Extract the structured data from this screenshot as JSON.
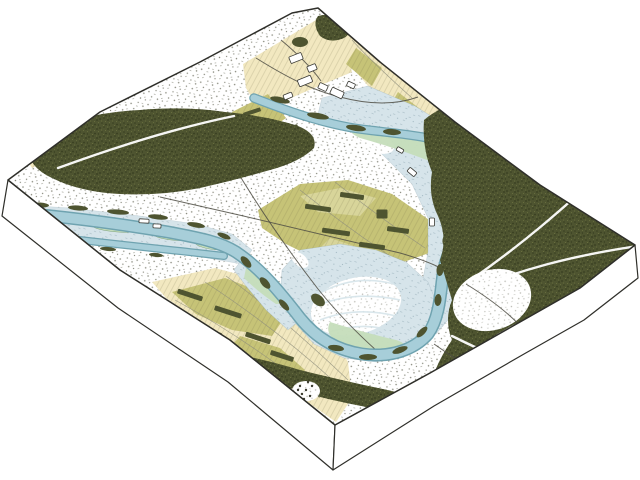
{
  "scene": {
    "type": "isometric-block-map-illustration",
    "background": "#ffffff",
    "depicted_features": [
      "river-channel",
      "oxbow-meander",
      "floodplain",
      "gravel-bars",
      "coniferous-forest",
      "forest-trails",
      "farm-fields",
      "hedgerows",
      "scrubland-stipple",
      "buildings",
      "roads",
      "channel-islands"
    ]
  },
  "colors": {
    "outline": "#2f2f2a",
    "forest": "#4e5430",
    "forest_dark": "#373e20",
    "forest_light": "#6b7240",
    "cream": "#f2e8c0",
    "olive": "#c6c377",
    "olive_light": "#d8d59a",
    "river_fill": "#a7ced9",
    "river_edge": "#6fa3b0",
    "flood": "#d6e4ea",
    "flood_mark": "#7d98a4",
    "marsh": "#c5ddbb",
    "stipple": "#5d5e4d",
    "road": "#4f4e44"
  },
  "map": {
    "field_patches": [
      {
        "d": "M243,64 L316,20 L345,42 L352,72 L300,94 L260,112 L246,88 Z",
        "cls": "cream"
      },
      {
        "d": "M330,16 L354,34 L400,70 L442,104 L452,126 L418,132 L380,100 L346,60 L320,30 Z",
        "cls": "cream"
      },
      {
        "d": "M356,48 L382,68 L372,86 L346,64 Z",
        "cls": "olive"
      },
      {
        "d": "M398,92 L424,112 L412,126 L390,106 Z",
        "cls": "olive"
      },
      {
        "d": "M232,112 L268,94 L286,118 L258,138 L236,130 Z",
        "cls": "olive"
      },
      {
        "d": "M20,150 L48,138 L60,154 L32,168 Z",
        "cls": "cream"
      },
      {
        "d": "M152,282 L215,268 L268,282 L305,302 L332,330 L348,362 L352,398 L336,422 L290,390 L240,352 L196,318 L166,298 Z",
        "cls": "cream"
      },
      {
        "d": "M172,292 L225,278 L262,292 L288,312 L272,336 L232,330 L196,314 Z",
        "cls": "olive"
      },
      {
        "d": "M240,336 L280,348 L305,370 L290,388 L252,366 L228,350 Z",
        "cls": "olive"
      },
      {
        "d": "M258,210 L300,184 L348,180 L392,194 L418,212 L440,228 L432,252 L398,264 L360,272 L322,262 L286,244 L262,228 Z",
        "cls": "olive"
      },
      {
        "d": "M300,196 L340,188 L376,198 L360,216 L318,212 Z",
        "cls": "olive2"
      },
      {
        "d": "M330,238 L372,252 L350,262 L316,252 Z",
        "cls": "olive2"
      }
    ],
    "field_lines": [
      {
        "d": "M175,300 C230,330 280,365 320,398"
      },
      {
        "d": "M205,282 C255,315 300,350 338,385"
      },
      {
        "d": "M226,276 C268,306 310,344 348,380"
      },
      {
        "d": "M300,190 C330,214 360,236 390,256"
      },
      {
        "d": "M335,182 C365,206 395,228 425,248"
      },
      {
        "d": "M352,40 C370,60 392,80 412,98"
      }
    ],
    "floodplain_zones": [
      {
        "d": "M322,98 L368,86 L415,106 L458,133 L492,166 L506,202 L498,240 L478,276 L458,308 L436,334 L412,318 L422,284 L428,252 L428,218 L412,184 L382,154 L348,130 L318,114 Z"
      },
      {
        "d": "M300,250 L340,244 L376,250 L406,262 L428,282 L438,306 L430,332 L406,352 L376,362 L344,358 L314,344 L294,322 L280,298 L282,270 Z"
      },
      {
        "d": "M6,204 L70,208 L140,216 L196,224 L232,234 L252,250 L242,264 L196,256 L130,248 L60,240 L6,236 Z"
      },
      {
        "d": "M240,262 L262,272 L286,296 L300,320 L288,330 L266,310 L246,286 L234,270 Z"
      }
    ],
    "gravel_bars": [
      {
        "x": 374,
        "y": 142,
        "rx": 21,
        "ry": 10,
        "r": 20
      },
      {
        "x": 480,
        "y": 196,
        "rx": 13,
        "ry": 7,
        "r": 75
      },
      {
        "x": 356,
        "y": 306,
        "rx": 46,
        "ry": 28,
        "r": -14
      },
      {
        "x": 300,
        "y": 260,
        "rx": 10,
        "ry": 6,
        "r": 40
      }
    ],
    "scroll_arcs": [
      {
        "d": "M322,292 Q356,274 394,284"
      },
      {
        "d": "M316,306 Q354,290 400,300"
      },
      {
        "d": "M320,320 Q356,306 396,316"
      },
      {
        "d": "M330,332 Q360,322 390,330"
      }
    ],
    "marsh_zones": [
      {
        "d": "M352,124 Q390,130 430,144 Q456,154 466,162 Q452,170 432,162 Q396,148 360,138 Q346,132 352,124 Z"
      },
      {
        "d": "M330,322 Q362,332 396,340 Q410,344 404,354 Q372,352 338,342 Q324,334 330,322 Z"
      },
      {
        "d": "M14,238 Q38,230 62,238 Q70,244 58,252 Q34,254 16,250 Z"
      },
      {
        "d": "M246,268 Q266,278 282,294 Q288,304 276,304 Q258,292 244,278 Z"
      }
    ],
    "channel_islands": [
      {
        "x": 118,
        "y": 227,
        "rx": 26,
        "ry": 5,
        "r": 4
      },
      {
        "x": 172,
        "y": 236,
        "rx": 20,
        "ry": 4,
        "r": 7
      },
      {
        "x": 210,
        "y": 245,
        "rx": 15,
        "ry": 4,
        "r": 10
      },
      {
        "x": 74,
        "y": 250,
        "rx": 12,
        "ry": 3,
        "r": 4
      }
    ],
    "roads": [
      {
        "d": "M160,197 C240,215 330,236 400,253 C432,262 452,272 466,284"
      },
      {
        "d": "M212,128 C244,186 280,240 318,289 C338,314 358,334 377,351"
      },
      {
        "d": "M256,58 C288,78 312,90 340,97 C370,105 396,105 418,97"
      },
      {
        "d": "M281,40 C299,55 311,67 321,81"
      }
    ],
    "roads_over": [
      {
        "d": "M434,344 C466,367 498,384 530,398"
      },
      {
        "d": "M466,284 C492,300 510,314 524,330"
      }
    ],
    "field_tree_strips": [
      {
        "x": 318,
        "y": 208,
        "w": 26,
        "h": 5,
        "r": 8
      },
      {
        "x": 352,
        "y": 196,
        "w": 24,
        "h": 5,
        "r": 8
      },
      {
        "x": 336,
        "y": 232,
        "w": 28,
        "h": 5,
        "r": 8
      },
      {
        "x": 372,
        "y": 246,
        "w": 26,
        "h": 5,
        "r": 8
      },
      {
        "x": 398,
        "y": 230,
        "w": 22,
        "h": 5,
        "r": 8
      },
      {
        "x": 382,
        "y": 214,
        "w": 11,
        "h": 9,
        "r": 0
      },
      {
        "x": 190,
        "y": 295,
        "w": 26,
        "h": 5,
        "r": 18
      },
      {
        "x": 228,
        "y": 312,
        "w": 28,
        "h": 5,
        "r": 18
      },
      {
        "x": 210,
        "y": 332,
        "w": 24,
        "h": 5,
        "r": 18
      },
      {
        "x": 258,
        "y": 338,
        "w": 26,
        "h": 5,
        "r": 18
      },
      {
        "x": 282,
        "y": 356,
        "w": 24,
        "h": 5,
        "r": 18
      },
      {
        "x": 248,
        "y": 368,
        "w": 20,
        "h": 5,
        "r": 18
      },
      {
        "x": 252,
        "y": 112,
        "w": 18,
        "h": 4,
        "r": -18
      },
      {
        "x": 290,
        "y": 128,
        "w": 16,
        "h": 4,
        "r": -14
      }
    ],
    "river_channels": [
      {
        "d": "M6,212 C60,216 120,224 168,232 C200,238 220,242 236,252 C260,268 280,292 300,318 C316,338 336,350 362,354 C390,358 414,350 428,334 C438,320 440,300 442,282 C444,262 450,246 460,236 C474,222 490,212 492,194 C494,176 480,160 460,148",
        "we": 13,
        "wf": 10
      },
      {
        "d": "M460,148 C434,136 400,134 368,130 C330,126 290,112 254,98",
        "we": 9.5,
        "wf": 7
      },
      {
        "d": "M6,232 C60,238 120,244 170,250 C190,252 206,254 224,256",
        "we": 8,
        "wf": 5.5
      }
    ],
    "bank_tree_clumps": [
      {
        "x": 40,
        "y": 205,
        "rx": 9,
        "ry": 2.5,
        "r": 3
      },
      {
        "x": 78,
        "y": 208,
        "rx": 10,
        "ry": 2.5,
        "r": 4
      },
      {
        "x": 118,
        "y": 212,
        "rx": 11,
        "ry": 2.5,
        "r": 5
      },
      {
        "x": 158,
        "y": 217,
        "rx": 10,
        "ry": 2.5,
        "r": 6
      },
      {
        "x": 196,
        "y": 225,
        "rx": 9,
        "ry": 2.5,
        "r": 10
      },
      {
        "x": 224,
        "y": 236,
        "rx": 7,
        "ry": 2.5,
        "r": 22
      },
      {
        "x": 60,
        "y": 243,
        "rx": 8,
        "ry": 2,
        "r": 4
      },
      {
        "x": 108,
        "y": 249,
        "rx": 8,
        "ry": 2,
        "r": 5
      },
      {
        "x": 156,
        "y": 255,
        "rx": 7,
        "ry": 2,
        "r": 6
      },
      {
        "x": 246,
        "y": 262,
        "rx": 7,
        "ry": 3.5,
        "r": 48
      },
      {
        "x": 265,
        "y": 283,
        "rx": 7,
        "ry": 3.5,
        "r": 48
      },
      {
        "x": 284,
        "y": 305,
        "rx": 7,
        "ry": 3,
        "r": 48
      },
      {
        "x": 336,
        "y": 348,
        "rx": 8,
        "ry": 3,
        "r": 8
      },
      {
        "x": 368,
        "y": 357,
        "rx": 9,
        "ry": 3,
        "r": 0
      },
      {
        "x": 400,
        "y": 350,
        "rx": 8,
        "ry": 3,
        "r": -20
      },
      {
        "x": 422,
        "y": 332,
        "rx": 7,
        "ry": 3,
        "r": -45
      },
      {
        "x": 438,
        "y": 300,
        "rx": 6,
        "ry": 3.5,
        "r": 95
      },
      {
        "x": 440,
        "y": 270,
        "rx": 6,
        "ry": 3.5,
        "r": 95
      },
      {
        "x": 446,
        "y": 240,
        "rx": 6,
        "ry": 3.5,
        "r": 100
      },
      {
        "x": 456,
        "y": 212,
        "rx": 6,
        "ry": 3.5,
        "r": 110
      },
      {
        "x": 468,
        "y": 188,
        "rx": 6,
        "ry": 3.5,
        "r": 130
      },
      {
        "x": 470,
        "y": 162,
        "rx": 7,
        "ry": 4,
        "r": 150
      },
      {
        "x": 448,
        "y": 143,
        "rx": 8,
        "ry": 4,
        "r": 170
      },
      {
        "x": 280,
        "y": 100,
        "rx": 10,
        "ry": 3,
        "r": 12
      },
      {
        "x": 318,
        "y": 116,
        "rx": 11,
        "ry": 3,
        "r": 10
      },
      {
        "x": 356,
        "y": 128,
        "rx": 10,
        "ry": 3,
        "r": 8
      },
      {
        "x": 392,
        "y": 132,
        "rx": 9,
        "ry": 3,
        "r": 4
      },
      {
        "x": 458,
        "y": 398,
        "rx": 12,
        "ry": 5,
        "r": -25
      },
      {
        "x": 508,
        "y": 352,
        "rx": 9,
        "ry": 4,
        "r": -25
      },
      {
        "x": 300,
        "y": 42,
        "rx": 8,
        "ry": 5,
        "r": 0
      },
      {
        "x": 318,
        "y": 300,
        "rx": 8,
        "ry": 5,
        "r": 40
      }
    ],
    "forest_masses": [
      {
        "d": "M28,150 Q40,128 70,122 Q100,112 140,110 Q185,106 225,112 Q268,116 298,126 Q318,134 314,148 Q300,162 270,170 Q235,180 200,188 Q160,196 120,194 Q80,192 52,178 Q30,168 28,150 Z"
      },
      {
        "d": "M424,120 Q448,100 474,104 Q504,108 534,128 Q566,148 596,176 Q622,200 634,222 L636,246 Q612,268 584,286 Q556,306 515,324 Q492,336 470,352 Q452,364 432,380 Q438,360 452,340 Q444,320 452,300 Q446,280 440,260 Q448,238 438,216 Q428,196 432,172 Q422,148 424,120 Z"
      },
      {
        "d": "M224,352 Q260,358 300,370 Q340,380 378,388 Q410,394 428,404 Q420,416 396,412 Q356,406 316,396 Q276,384 244,372 Q222,364 224,352 Z"
      },
      {
        "d": "M318,16 Q334,12 348,20 Q356,30 344,38 Q330,44 320,36 Q312,24 318,16 Z"
      }
    ],
    "forest_clearings": [
      {
        "x": 492,
        "y": 300,
        "rx": 40,
        "ry": 30,
        "r": -18
      },
      {
        "x": 306,
        "y": 391,
        "rx": 14,
        "ry": 10,
        "r": 0
      }
    ],
    "forest_trails": [
      {
        "d": "M468,282 C514,250 560,214 638,138"
      },
      {
        "d": "M470,290 C520,270 570,256 638,246"
      },
      {
        "d": "M452,336 C492,356 536,374 584,390"
      },
      {
        "d": "M58,168 C118,146 176,128 234,116"
      }
    ],
    "buildings": [
      {
        "x": 296,
        "y": 58,
        "w": 13,
        "h": 7,
        "r": -22
      },
      {
        "x": 312,
        "y": 68,
        "w": 9,
        "h": 6,
        "r": -22
      },
      {
        "x": 305,
        "y": 81,
        "w": 14,
        "h": 7,
        "r": -22
      },
      {
        "x": 323,
        "y": 87,
        "w": 9,
        "h": 6,
        "r": 25
      },
      {
        "x": 337,
        "y": 93,
        "w": 13,
        "h": 7,
        "r": 25
      },
      {
        "x": 288,
        "y": 96,
        "w": 9,
        "h": 5,
        "r": -22
      },
      {
        "x": 351,
        "y": 85,
        "w": 8,
        "h": 5,
        "r": 25
      },
      {
        "x": 144,
        "y": 221,
        "w": 10,
        "h": 4,
        "r": 3
      },
      {
        "x": 157,
        "y": 226,
        "w": 8,
        "h": 4,
        "r": 3
      },
      {
        "x": 412,
        "y": 172,
        "w": 9,
        "h": 5,
        "r": 40
      },
      {
        "x": 432,
        "y": 222,
        "w": 8,
        "h": 5,
        "r": 90
      },
      {
        "x": 400,
        "y": 150,
        "w": 7,
        "h": 4,
        "r": 30
      }
    ],
    "orchard_dots": [
      {
        "x": 300,
        "y": 386
      },
      {
        "x": 306,
        "y": 390
      },
      {
        "x": 312,
        "y": 386
      },
      {
        "x": 302,
        "y": 394
      },
      {
        "x": 310,
        "y": 396
      },
      {
        "x": 298,
        "y": 390
      },
      {
        "x": 308,
        "y": 382
      },
      {
        "x": 304,
        "y": 399
      }
    ]
  }
}
